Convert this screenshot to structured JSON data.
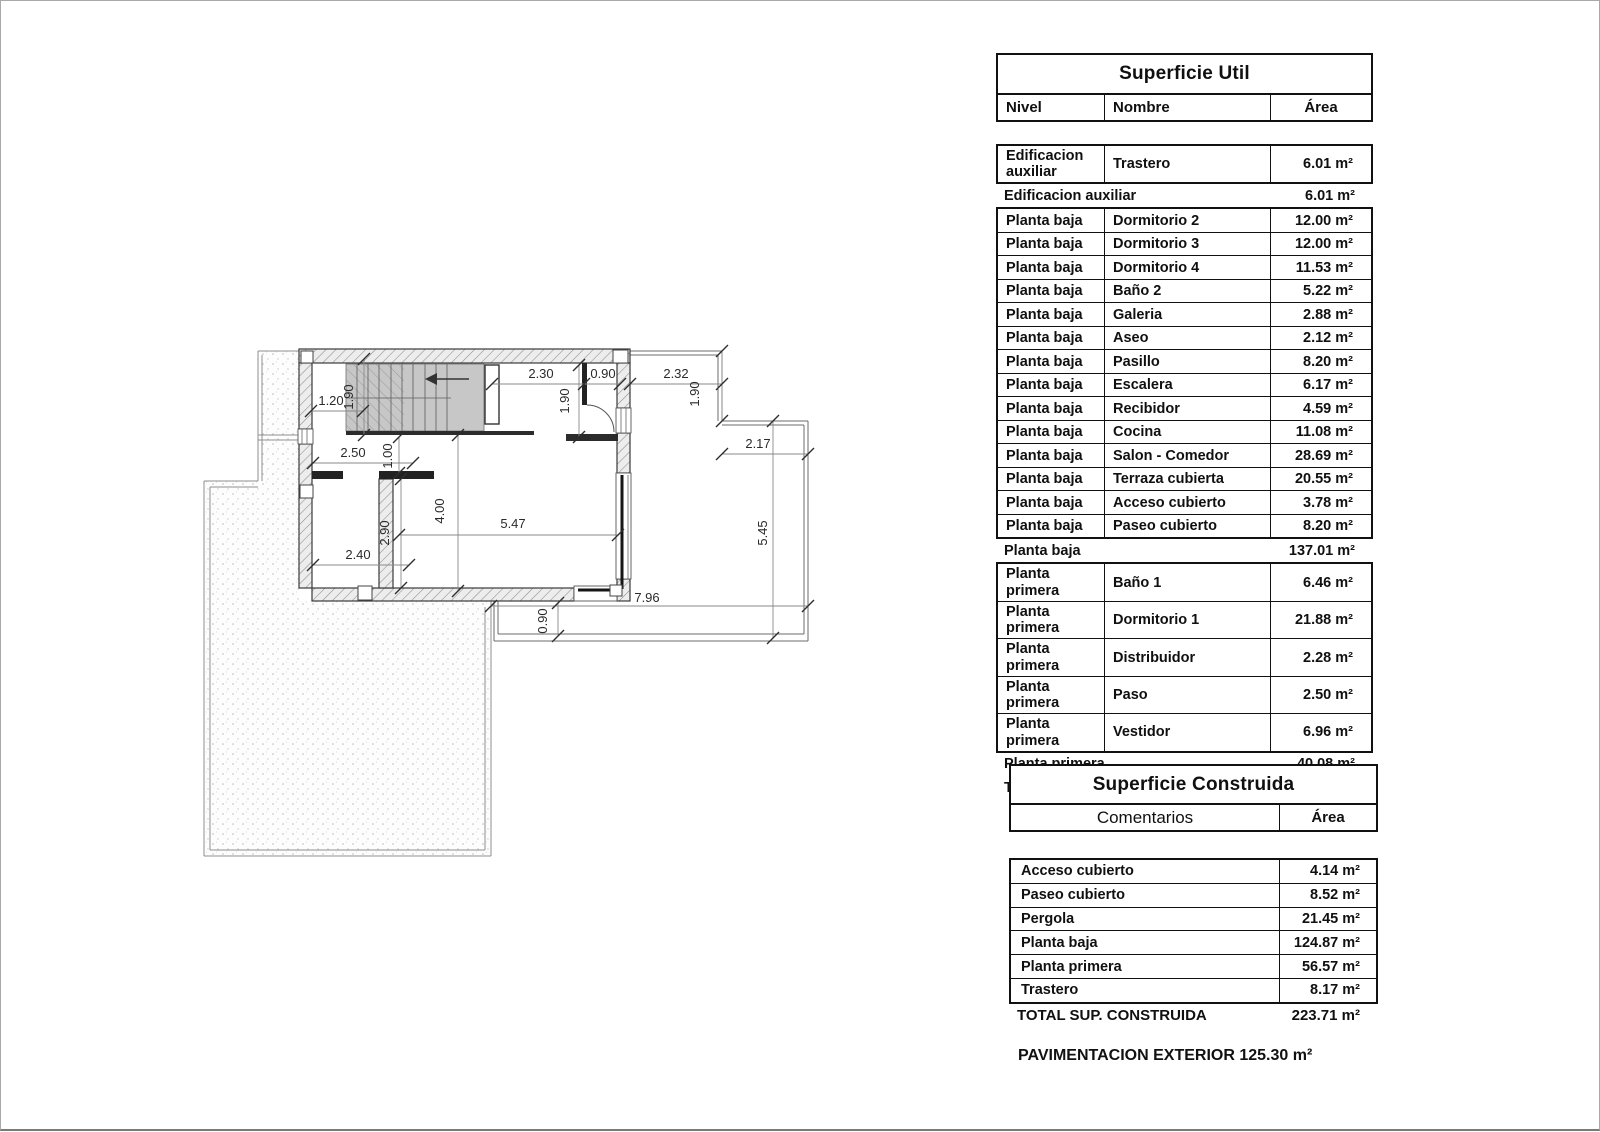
{
  "superficie_util": {
    "title": "Superficie Util",
    "columns": {
      "nivel": "Nivel",
      "nombre": "Nombre",
      "area": "Área"
    },
    "sections": [
      {
        "rows": [
          {
            "nivel": "Edificacion auxiliar",
            "nombre": "Trastero",
            "area": "6.01 m²"
          }
        ],
        "summary": {
          "label": "Edificacion auxiliar",
          "area": "6.01 m²"
        }
      },
      {
        "rows": [
          {
            "nivel": "Planta baja",
            "nombre": "Dormitorio 2",
            "area": "12.00 m²"
          },
          {
            "nivel": "Planta baja",
            "nombre": "Dormitorio 3",
            "area": "12.00 m²"
          },
          {
            "nivel": "Planta baja",
            "nombre": "Dormitorio 4",
            "area": "11.53 m²"
          },
          {
            "nivel": "Planta baja",
            "nombre": "Baño 2",
            "area": "5.22 m²"
          },
          {
            "nivel": "Planta baja",
            "nombre": "Galeria",
            "area": "2.88 m²"
          },
          {
            "nivel": "Planta baja",
            "nombre": "Aseo",
            "area": "2.12 m²"
          },
          {
            "nivel": "Planta baja",
            "nombre": "Pasillo",
            "area": "8.20 m²"
          },
          {
            "nivel": "Planta baja",
            "nombre": "Escalera",
            "area": "6.17 m²"
          },
          {
            "nivel": "Planta baja",
            "nombre": "Recibidor",
            "area": "4.59 m²"
          },
          {
            "nivel": "Planta baja",
            "nombre": "Cocina",
            "area": "11.08 m²"
          },
          {
            "nivel": "Planta baja",
            "nombre": "Salon - Comedor",
            "area": "28.69 m²"
          },
          {
            "nivel": "Planta baja",
            "nombre": "Terraza cubierta",
            "area": "20.55 m²"
          },
          {
            "nivel": "Planta baja",
            "nombre": "Acceso cubierto",
            "area": "3.78 m²"
          },
          {
            "nivel": "Planta baja",
            "nombre": "Paseo cubierto",
            "area": "8.20 m²"
          }
        ],
        "summary": {
          "label": "Planta baja",
          "area": "137.01 m²"
        }
      },
      {
        "rows": [
          {
            "nivel": "Planta primera",
            "nombre": "Baño 1",
            "area": "6.46 m²"
          },
          {
            "nivel": "Planta primera",
            "nombre": "Dormitorio 1",
            "area": "21.88 m²"
          },
          {
            "nivel": "Planta primera",
            "nombre": "Distribuidor",
            "area": "2.28 m²"
          },
          {
            "nivel": "Planta primera",
            "nombre": "Paso",
            "area": "2.50 m²"
          },
          {
            "nivel": "Planta primera",
            "nombre": "Vestidor",
            "area": "6.96 m²"
          }
        ],
        "summary": {
          "label": "Planta primera",
          "area": "40.08 m²"
        }
      }
    ],
    "total": {
      "label": "TOTAL SUP. UTIL",
      "area": "183.10 m²"
    }
  },
  "superficie_construida": {
    "title": "Superficie Construida",
    "columns": {
      "comentarios": "Comentarios",
      "area": "Área"
    },
    "rows": [
      {
        "label": "Acceso cubierto",
        "area": "4.14 m²"
      },
      {
        "label": "Paseo cubierto",
        "area": "8.52 m²"
      },
      {
        "label": "Pergola",
        "area": "21.45 m²"
      },
      {
        "label": "Planta baja",
        "area": "124.87 m²"
      },
      {
        "label": "Planta primera",
        "area": "56.57 m²"
      },
      {
        "label": "Trastero",
        "area": "8.17 m²"
      }
    ],
    "total": {
      "label": "TOTAL SUP. CONSTRUIDA",
      "area": "223.71 m²"
    }
  },
  "footer_note": "PAVIMENTACION EXTERIOR 125.30 m²",
  "plan": {
    "dims": [
      {
        "text": "1.20",
        "x": 330,
        "y": 404,
        "rot": 0
      },
      {
        "text": "1.90",
        "x": 352,
        "y": 396,
        "rot": -90
      },
      {
        "text": "2.30",
        "x": 540,
        "y": 377,
        "rot": 0
      },
      {
        "text": "0.90",
        "x": 602,
        "y": 377,
        "rot": 0
      },
      {
        "text": "2.32",
        "x": 675,
        "y": 377,
        "rot": 0
      },
      {
        "text": "1.90",
        "x": 568,
        "y": 400,
        "rot": -90
      },
      {
        "text": "1.90",
        "x": 698,
        "y": 393,
        "rot": -90
      },
      {
        "text": "2.17",
        "x": 757,
        "y": 447,
        "rot": 0
      },
      {
        "text": "5.45",
        "x": 766,
        "y": 532,
        "rot": -90
      },
      {
        "text": "2.50",
        "x": 352,
        "y": 456,
        "rot": 0
      },
      {
        "text": "1.00",
        "x": 391,
        "y": 455,
        "rot": -90
      },
      {
        "text": "4.00",
        "x": 443,
        "y": 510,
        "rot": -90
      },
      {
        "text": "5.47",
        "x": 512,
        "y": 527,
        "rot": 0
      },
      {
        "text": "2.90",
        "x": 388,
        "y": 532,
        "rot": -90
      },
      {
        "text": "2.40",
        "x": 357,
        "y": 558,
        "rot": 0
      },
      {
        "text": "7.96",
        "x": 646,
        "y": 601,
        "rot": 0
      },
      {
        "text": "0.90",
        "x": 546,
        "y": 620,
        "rot": -90
      }
    ]
  }
}
